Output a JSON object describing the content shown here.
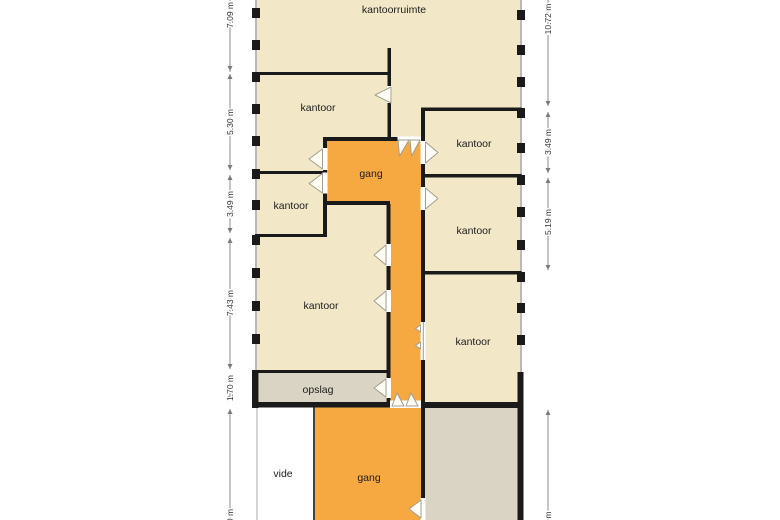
{
  "floorplan": {
    "rooms": {
      "kantoorruimte": "kantoorruimte",
      "kantoor_top_left": "kantoor",
      "kantoor_right_1": "kantoor",
      "gang_upper": "gang",
      "kantoor_mid_left": "kantoor",
      "kantoor_right_2": "kantoor",
      "kantoor_lower_left": "kantoor",
      "kantoor_right_3": "kantoor",
      "opslag": "opslag",
      "vide": "vide",
      "gang_lower": "gang"
    },
    "dimensions": {
      "left": [
        "7.09 m",
        "5.30 m",
        "3.49 m",
        "7.43 m",
        "1.70 m",
        "0 m"
      ],
      "right": [
        "10.72 m",
        "3.49 m",
        "5.19 m",
        "m"
      ]
    },
    "colors": {
      "room_fill": "#f2e8c8",
      "corridor_fill": "#f7a941",
      "storage_fill": "#d9d4c3",
      "wall": "#1a1a1a",
      "facade": "#b9b9b9",
      "dimension": "#8c8c8c",
      "label_text": "#1c1c1c"
    }
  }
}
